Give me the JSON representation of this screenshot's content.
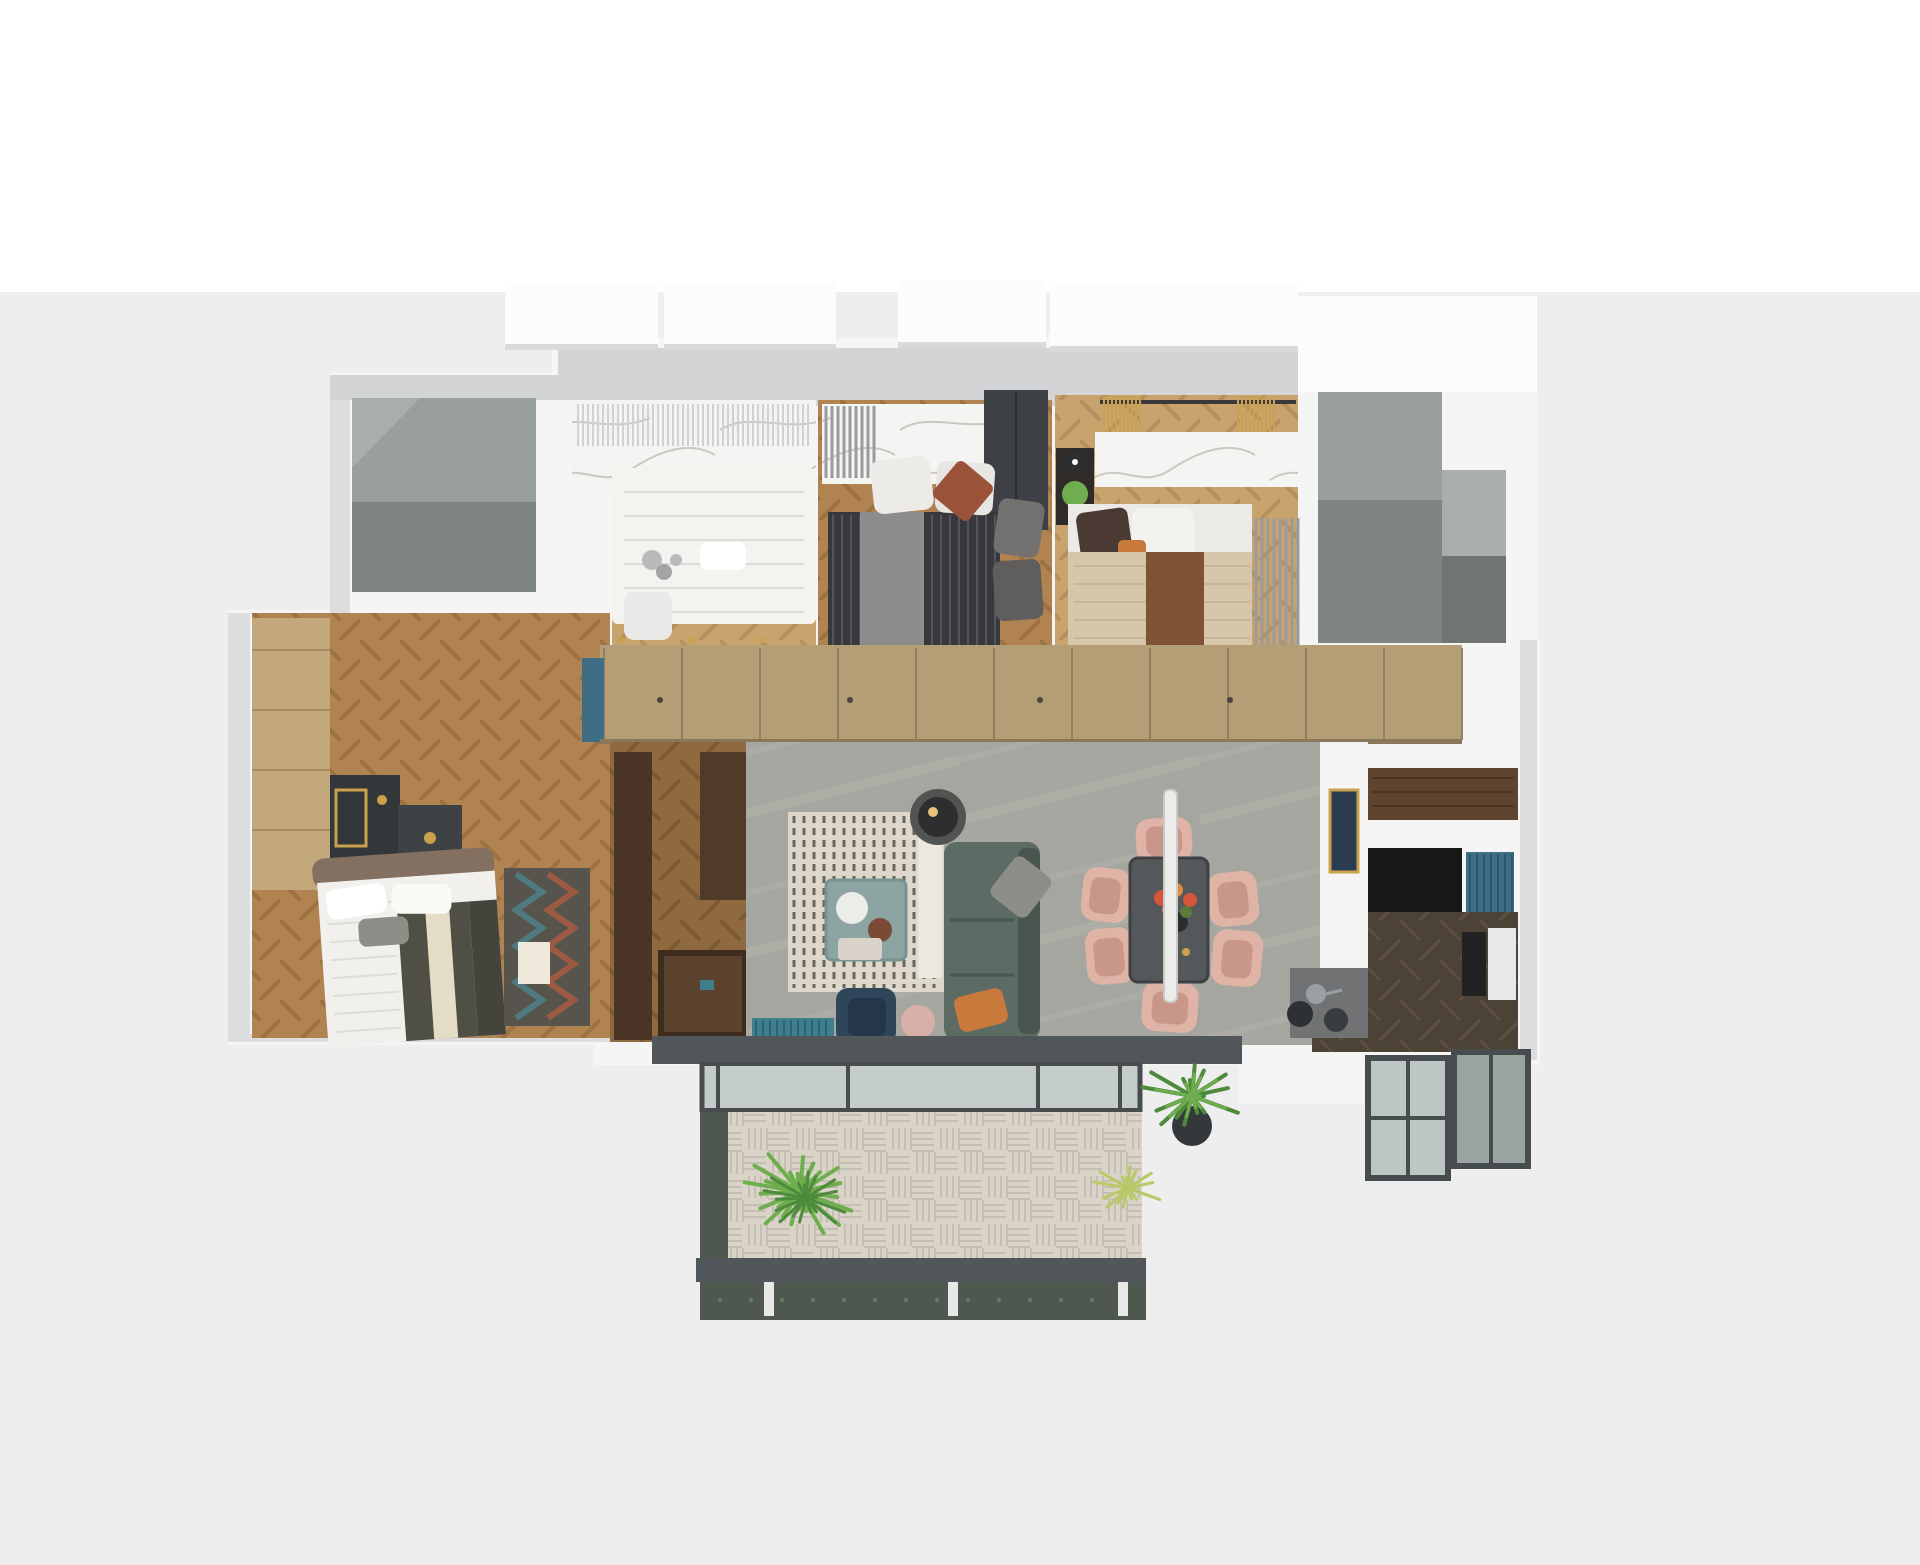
{
  "scene": {
    "kind": "3d-apartment-floor-plan-render",
    "view": "top-down dollhouse render, no visible text",
    "background": "#eeeeef",
    "background_top": "#ffffff"
  },
  "palette": {
    "bg": "#eeeeef",
    "bgTop": "#ffffff",
    "wall": "#f5f5f6",
    "wallShade": "#dcdddf",
    "wallBand": "#d2d4d5",
    "slab": "#fcfcfd",
    "slabShadow": "#d8d9db",
    "voidA": "#99a09c",
    "voidB": "#7f8681",
    "voidC": "#a9aeab",
    "voidD": "#6f7571",
    "woodL": "#c9a36e",
    "woodLs": "#b58f5c",
    "woodM": "#b08350",
    "woodMs": "#9c7242",
    "woodD": "#8f6a3e",
    "woodDs": "#7c5a33",
    "woodK": "#4c4236",
    "woodKs": "#5c5043",
    "marble": "#f4f4f2",
    "vein": "#c9c9c2",
    "curtainSheer": "#d0d1d3",
    "curtainGray": "#9b9b9d",
    "curtainGold": "#c9a24f",
    "curtainOffice": "#8a7158",
    "closet": "#b39e75",
    "closetSeam": "#94805c",
    "living": "#a6a6a1",
    "livingVein": "#bab8b0",
    "rugBase": "#ddd8cb",
    "rugStripe": "#6b655c",
    "rugEdge": "#ebe8df",
    "sofa": "#5c6b64",
    "sofaDark": "#49564f",
    "pillowGray": "#8e8e88",
    "pillowOrange": "#c87a3c",
    "lampBlack": "#2c2e30",
    "lampGlow": "#e8c27a",
    "lampBase": "#515450",
    "cTable": "#8ca4a2",
    "cTableEdge": "#7a9391",
    "tray": "#eceee9",
    "basket": "#7a4a35",
    "navyChair": "#2f4559",
    "navySeat": "#243649",
    "ottoman": "#d9b0a8",
    "throwTeal": "#3f7e8d",
    "throwTealDark": "#2f6272",
    "dTable": "#55585b",
    "dTableEdge": "#3e4143",
    "blush": "#dfb3a6",
    "blushSeat": "#c9968a",
    "pendant": "#ececea",
    "pendantEdge": "#c9c9c6",
    "flowerRed": "#d6543a",
    "flowerOrange": "#e08a3c",
    "flowerGreen": "#5d7a3a",
    "vase": "#2a2c2d",
    "gold": "#c9a24b",
    "bedWhite": "#f1f0ed",
    "bedFold": "#dcdcd8",
    "olive": "#504f46",
    "creamBand": "#e5dcc5",
    "oliveDark": "#44433c",
    "headboard": "#837061",
    "chevBase": "#57534d",
    "chevTeal": "#4e7a80",
    "chevRust": "#9c5b41",
    "rugCard": "#efe9dc",
    "duvetDark": "#37383b",
    "duvetStripe": "#54555a",
    "throwGrayB": "#8e8d8b",
    "wardrobeDark": "#3d4145",
    "bedBeige": "#d6c7ab",
    "runnerBrown": "#7e5233",
    "pillowRust": "#9a5238",
    "pillowBrown": "#4a3a33",
    "pillowGrayB": "#73716f",
    "pillowGrayC": "#5f5e5c",
    "plantGreen": "#6fae4e",
    "plantDark": "#4e8a3c",
    "plantYellow": "#b9c968",
    "pot": "#33383a",
    "shelfDark": "#3a2e26",
    "shelfLine": "#241f1a",
    "accentYellow": "#e8b431",
    "deskBlack": "#1f2022",
    "chairDark": "#35383b",
    "glass": "#ccd7d8",
    "glassEdge": "#b6c2c4",
    "masterWardrobe": "#c3a87c",
    "masterWardrobeSeam": "#a58c63",
    "consoleDark": "#3e2c1e",
    "consoleTop": "#5a422e",
    "pillarWood": "#4a3425",
    "pillarWood2": "#503a28",
    "tealCab": "#3e6e85",
    "parapet": "#50565a",
    "paneGlass": "#bcc6c3",
    "frame": "#474d4f",
    "deck": "#d9d4c7",
    "deckLine": "#c4bfb2",
    "marbleGreen": "#4e584e",
    "marbleGreenHi": "#6a7a66",
    "balustrade": "#e8e8e8",
    "navyArt": "#2c3c50",
    "counterWood": "#5f4430",
    "cabBlack": "#181818",
    "stoveGray": "#707274",
    "panA": "#9aa0a2",
    "panB": "#3a3d3f",
    "stool": "#2e3133",
    "fridge": "#e8e8e8",
    "oven": "#222222",
    "kidsBed": "#f4f3f0",
    "plush": "#b9babc",
    "chairWhite": "#e9e9e7",
    "plush2": "#a3a4a6"
  },
  "regions": [
    {
      "name": "void-room-top-left",
      "furniture": []
    },
    {
      "name": "kids-room",
      "furniture": [
        "white-bed",
        "plush-toy",
        "marble-wall",
        "sheer-curtain"
      ]
    },
    {
      "name": "bedroom-middle",
      "furniture": [
        "dark-striped-bed",
        "gray-throw",
        "rust-pillow",
        "marble-headboard",
        "dark-wardrobe"
      ]
    },
    {
      "name": "bedroom-right",
      "furniture": [
        "beige-bed",
        "brown-runner",
        "marble-ledge",
        "gold-curtains",
        "plant-side-table"
      ]
    },
    {
      "name": "stairwell-void-top-right",
      "furniture": []
    },
    {
      "name": "office",
      "furniture": [
        "bookshelf",
        "desk",
        "office-chair",
        "glass-partition",
        "curtain"
      ]
    },
    {
      "name": "master-bedroom",
      "furniture": [
        "bed",
        "chevron-rug",
        "vanity-mirror",
        "nightstand",
        "wardrobe-column"
      ]
    },
    {
      "name": "hallway-closet",
      "furniture": [
        "tan-wardrobe-doors",
        "teal-cabinet"
      ]
    },
    {
      "name": "entrance",
      "furniture": [
        "wood-pillars",
        "console-table"
      ]
    },
    {
      "name": "living-room",
      "furniture": [
        "striped-rug",
        "green-sofa",
        "teal-coffee-table",
        "floor-lamp",
        "navy-lounge-chair",
        "ottoman",
        "teal-throw-bench"
      ]
    },
    {
      "name": "dining-area",
      "furniture": [
        "dark-table",
        "six-blush-chairs",
        "linear-pendant",
        "flower-centerpiece"
      ]
    },
    {
      "name": "kitchen",
      "furniture": [
        "wood-countertop",
        "black-cabinets",
        "teal-cabinet",
        "breakfast-counter",
        "pans",
        "stool",
        "navy-art-panel"
      ]
    },
    {
      "name": "main-balcony",
      "furniture": [
        "glass-sliding-doors",
        "wood-deck",
        "fern-plant",
        "palm-plant",
        "yellow-plant",
        "green-marble-parapet"
      ]
    },
    {
      "name": "small-balcony-right",
      "furniture": [
        "glazed-frames"
      ]
    }
  ]
}
